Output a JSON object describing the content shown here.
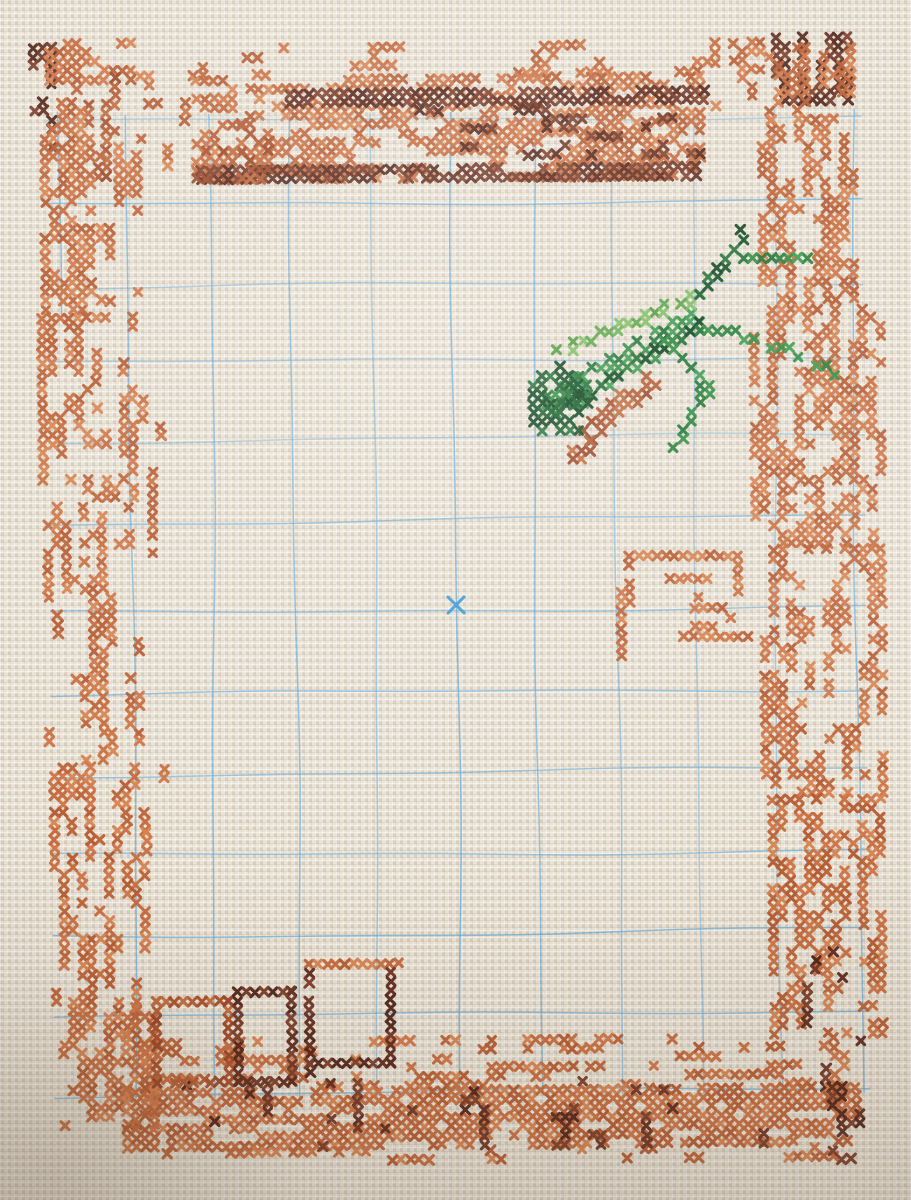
{
  "scene": {
    "subject": "cross-stitch embroidery in progress on cream aida fabric",
    "has_text": false,
    "motifs": [
      "wood-grain top border band",
      "scattered orange bark-like side borders",
      "green grasshopper with rust underwing",
      "three stitched window outlines bottom-left",
      "partial orange outline motif middle-right",
      "dense wavy bottom border"
    ],
    "fabric_color": "#eae3d6"
  },
  "grid": {
    "color": "#5ea6d6",
    "center_mark_color": "#2f93d6",
    "vertical_x": [
      132,
      213,
      295,
      375,
      456,
      537,
      617,
      697,
      777,
      857
    ],
    "v_y0": 112,
    "v_y1": 1096,
    "horizontal_y": [
      119,
      202,
      285,
      360,
      438,
      520,
      610,
      692,
      772,
      853,
      933,
      1014,
      1092
    ],
    "h_x0": 50,
    "h_x1": 866,
    "stub": {
      "x": 61,
      "y0": 108,
      "y1": 312
    },
    "center_mark": {
      "x": 456,
      "y": 605
    }
  },
  "palette": {
    "orange": [
      "#c5683a",
      "#cf7446",
      "#b55a30",
      "#d6824f",
      "#bc6236",
      "#c86e3e"
    ],
    "darkbrown": [
      "#5f2a1c",
      "#6e3424",
      "#502218",
      "#7a3c28"
    ],
    "rust": [
      "#a94e2a",
      "#b25a32",
      "#9a4524",
      "#bf6a3c"
    ],
    "green": [
      "#2f8c42",
      "#26803a",
      "#3b9a4e",
      "#1f7434"
    ],
    "darkgreen": [
      "#1a5e2d",
      "#124f26",
      "#247038",
      "#0f4520"
    ],
    "lightgreen": [
      "#5aa447",
      "#4f9a40",
      "#6ab153",
      "#7fbc62"
    ]
  },
  "regions": [
    {
      "n": "tl-outer-dark",
      "t": "scatter",
      "x": 34,
      "y": 40,
      "w": 26,
      "h": 112,
      "c": "darkbrown",
      "d": 0.55,
      "dir": "v"
    },
    {
      "n": "tl-corner",
      "t": "scatter",
      "x": 50,
      "y": 36,
      "w": 92,
      "h": 58,
      "c": "orange",
      "d": 0.6,
      "dir": "h"
    },
    {
      "n": "tl-hook",
      "t": "scatter",
      "x": 88,
      "y": 70,
      "w": 36,
      "h": 112,
      "c": "rust",
      "d": 0.45,
      "dir": "v"
    },
    {
      "n": "tl-col-outer",
      "t": "scatter",
      "x": 44,
      "y": 95,
      "w": 52,
      "h": 215,
      "c": "orange",
      "d": 0.42,
      "dir": "v"
    },
    {
      "n": "tl-col-inner",
      "t": "scatter",
      "x": 100,
      "y": 140,
      "w": 44,
      "h": 170,
      "c": "orange",
      "d": 0.28,
      "dir": "v"
    },
    {
      "n": "top-sparse",
      "t": "scatter",
      "x": 140,
      "y": 42,
      "w": 600,
      "h": 34,
      "c": "orange",
      "d": 0.22,
      "dir": "h"
    },
    {
      "n": "top-left-sparse",
      "t": "scatter",
      "x": 140,
      "y": 78,
      "w": 66,
      "h": 104,
      "c": "orange",
      "d": 0.2,
      "dir": "v"
    },
    {
      "n": "log-main",
      "t": "scatter",
      "x": 196,
      "y": 74,
      "w": 515,
      "h": 108,
      "c": "orange",
      "d": 0.62,
      "dir": "h"
    },
    {
      "n": "log-dark-top",
      "t": "scatter",
      "x": 290,
      "y": 88,
      "w": 420,
      "h": 16,
      "c": "darkbrown",
      "d": 0.8,
      "dir": "h"
    },
    {
      "n": "log-dark-mid",
      "t": "scatter",
      "x": 420,
      "y": 106,
      "w": 290,
      "h": 58,
      "c": "darkbrown",
      "d": 0.25,
      "dir": "h"
    },
    {
      "n": "log-dark-bottom",
      "t": "scatter",
      "x": 200,
      "y": 164,
      "w": 505,
      "h": 16,
      "c": "darkbrown",
      "d": 0.85,
      "dir": "h"
    },
    {
      "n": "log-left-rust",
      "t": "scatter",
      "x": 196,
      "y": 118,
      "w": 84,
      "h": 62,
      "c": "rust",
      "d": 0.3,
      "dir": "h"
    },
    {
      "n": "tr-strips",
      "t": "scatter",
      "x": 716,
      "y": 40,
      "w": 56,
      "h": 72,
      "c": "orange",
      "d": 0.4,
      "dir": "v"
    },
    {
      "n": "tr-corner-dark",
      "t": "scatter",
      "x": 776,
      "y": 36,
      "w": 84,
      "h": 72,
      "c": "darkbrown",
      "d": 0.5,
      "dir": "v"
    },
    {
      "n": "tr-corner-orange",
      "t": "scatter",
      "x": 770,
      "y": 46,
      "w": 92,
      "h": 78,
      "c": "orange",
      "d": 0.4,
      "dir": "v"
    },
    {
      "n": "border-right-1",
      "t": "scatter",
      "x": 762,
      "y": 118,
      "w": 100,
      "h": 190,
      "c": "orange",
      "d": 0.45,
      "dir": "v"
    },
    {
      "n": "border-right-2",
      "t": "scatter",
      "x": 752,
      "y": 308,
      "w": 135,
      "h": 240,
      "c": "orange",
      "d": 0.5,
      "dir": "v"
    },
    {
      "n": "border-right-3",
      "t": "scatter",
      "x": 760,
      "y": 548,
      "w": 125,
      "h": 250,
      "c": "orange",
      "d": 0.46,
      "dir": "v"
    },
    {
      "n": "border-right-4",
      "t": "scatter",
      "x": 766,
      "y": 798,
      "w": 118,
      "h": 247,
      "c": "orange",
      "d": 0.5,
      "dir": "v"
    },
    {
      "n": "border-right-dark",
      "t": "scatter",
      "x": 790,
      "y": 950,
      "w": 80,
      "h": 140,
      "c": "darkbrown",
      "d": 0.1,
      "dir": "v"
    },
    {
      "n": "right-gap-dots",
      "t": "scatter",
      "x": 826,
      "y": 1046,
      "w": 22,
      "h": 44,
      "c": "orange",
      "d": 0.3,
      "dir": "v"
    },
    {
      "n": "border-left-1",
      "t": "scatter",
      "x": 40,
      "y": 310,
      "w": 100,
      "h": 190,
      "c": "orange",
      "d": 0.4,
      "dir": "v"
    },
    {
      "n": "border-left-2",
      "t": "scatter",
      "x": 44,
      "y": 500,
      "w": 100,
      "h": 260,
      "c": "orange",
      "d": 0.42,
      "dir": "v"
    },
    {
      "n": "border-left-3",
      "t": "scatter",
      "x": 48,
      "y": 760,
      "w": 100,
      "h": 250,
      "c": "orange",
      "d": 0.45,
      "dir": "v"
    },
    {
      "n": "border-left-4",
      "t": "scatter",
      "x": 56,
      "y": 1010,
      "w": 95,
      "h": 118,
      "c": "orange",
      "d": 0.5,
      "dir": "v"
    },
    {
      "n": "left-singles",
      "t": "scatter",
      "x": 140,
      "y": 330,
      "w": 28,
      "h": 650,
      "c": "orange",
      "d": 0.06,
      "dir": "v"
    },
    {
      "n": "bottom-wave-top",
      "t": "scatter",
      "x": 150,
      "y": 1036,
      "w": 680,
      "h": 52,
      "c": "orange",
      "d": 0.3,
      "dir": "h"
    },
    {
      "n": "bottom-main",
      "t": "scatter",
      "x": 118,
      "y": 1086,
      "w": 736,
      "h": 62,
      "c": "orange",
      "d": 0.8,
      "dir": "h"
    },
    {
      "n": "bottom-ragged",
      "t": "scatter",
      "x": 140,
      "y": 1146,
      "w": 700,
      "h": 22,
      "c": "orange",
      "d": 0.25,
      "dir": "h"
    },
    {
      "n": "bottom-dark-specks",
      "t": "scatter",
      "x": 160,
      "y": 1078,
      "w": 660,
      "h": 72,
      "c": "darkbrown",
      "d": 0.07,
      "dir": "v"
    },
    {
      "n": "bottom-right-dark",
      "t": "scatter",
      "x": 824,
      "y": 1086,
      "w": 34,
      "h": 80,
      "c": "darkbrown",
      "d": 0.45,
      "dir": "v"
    },
    {
      "n": "bottom-left-join",
      "t": "scatter",
      "x": 118,
      "y": 1000,
      "w": 40,
      "h": 88,
      "c": "orange",
      "d": 0.45,
      "dir": "v"
    },
    {
      "n": "window-a",
      "t": "rect",
      "x": 150,
      "y": 998,
      "w": 74,
      "h": 86,
      "c": "rust"
    },
    {
      "n": "window-b",
      "t": "rect",
      "x": 230,
      "y": 988,
      "w": 60,
      "h": 88,
      "c": "darkbrown"
    },
    {
      "n": "window-c-top",
      "t": "hline",
      "x": 302,
      "y": 962,
      "w": 92,
      "c": "orange"
    },
    {
      "n": "window-c-left",
      "t": "vline",
      "x": 302,
      "y": 972,
      "h": 100,
      "c": "darkbrown"
    },
    {
      "n": "window-c-right",
      "t": "vline",
      "x": 386,
      "y": 972,
      "h": 94,
      "c": "darkbrown"
    },
    {
      "n": "window-c-bottom",
      "t": "hline",
      "x": 310,
      "y": 1064,
      "w": 80,
      "c": "darkbrown"
    },
    {
      "n": "motif-top",
      "t": "hline",
      "x": 630,
      "y": 558,
      "w": 108,
      "c": "orange"
    },
    {
      "n": "motif-left-a",
      "t": "vline",
      "x": 630,
      "y": 568,
      "h": 44,
      "c": "orange"
    },
    {
      "n": "motif-left-b",
      "t": "vline",
      "x": 622,
      "y": 598,
      "h": 56,
      "c": "orange"
    },
    {
      "n": "motif-ticks",
      "t": "scatter",
      "x": 648,
      "y": 576,
      "w": 64,
      "h": 26,
      "c": "orange",
      "d": 0.3,
      "dir": "h"
    },
    {
      "n": "motif-inner",
      "t": "scatter",
      "x": 690,
      "y": 606,
      "w": 44,
      "h": 26,
      "c": "orange",
      "d": 0.35,
      "dir": "h"
    },
    {
      "n": "motif-bottom",
      "t": "hline",
      "x": 684,
      "y": 642,
      "w": 60,
      "c": "orange"
    },
    {
      "n": "motif-right-stub",
      "t": "vline",
      "x": 740,
      "y": 566,
      "h": 30,
      "c": "orange"
    },
    {
      "n": "mantis-wing",
      "t": "line",
      "p": [
        [
          552,
          408
        ],
        [
          700,
          320
        ]
      ],
      "w": 24,
      "c": "green",
      "d": 0.95
    },
    {
      "n": "mantis-wing-edge",
      "t": "line",
      "p": [
        [
          556,
          414
        ],
        [
          700,
          328
        ]
      ],
      "w": 8,
      "c": "darkgreen",
      "d": 0.7
    },
    {
      "n": "mantis-wing-top",
      "t": "line",
      "p": [
        [
          560,
          352
        ],
        [
          702,
          298
        ]
      ],
      "w": 9,
      "c": "lightgreen",
      "d": 0.85
    },
    {
      "n": "mantis-abdomen",
      "t": "line",
      "p": [
        [
          592,
          434
        ],
        [
          658,
          378
        ]
      ],
      "w": 17,
      "c": "rust",
      "d": 0.9
    },
    {
      "n": "mantis-head",
      "t": "blob",
      "cx": 562,
      "cy": 402,
      "rx": 36,
      "ry": 34,
      "c": "darkgreen",
      "d": 0.78
    },
    {
      "n": "mantis-tail",
      "t": "scatter",
      "x": 560,
      "y": 438,
      "w": 46,
      "h": 30,
      "c": "rust",
      "d": 0.4,
      "dir": "v"
    },
    {
      "n": "mantis-antenna",
      "t": "line",
      "p": [
        [
          700,
          298
        ],
        [
          748,
          240
        ]
      ],
      "w": 1,
      "c": "darkgreen",
      "d": 1
    },
    {
      "n": "mantis-antenna-tip",
      "t": "cell",
      "x": 744,
      "y": 232,
      "c": "darkgreen"
    },
    {
      "n": "mantis-arm",
      "t": "line",
      "p": [
        [
          750,
          258
        ],
        [
          806,
          258
        ]
      ],
      "w": 10,
      "c": "green",
      "d": 0.95
    },
    {
      "n": "mantis-foreleg",
      "t": "line",
      "p": [
        [
          704,
          330
        ],
        [
          762,
          342
        ],
        [
          810,
          362
        ],
        [
          840,
          380
        ]
      ],
      "w": 10,
      "c": "green",
      "d": 0.9
    },
    {
      "n": "mantis-hindleg",
      "t": "line",
      "p": [
        [
          662,
          334
        ],
        [
          710,
          388
        ],
        [
          678,
          446
        ]
      ],
      "w": 9,
      "c": "green",
      "d": 0.95
    }
  ]
}
